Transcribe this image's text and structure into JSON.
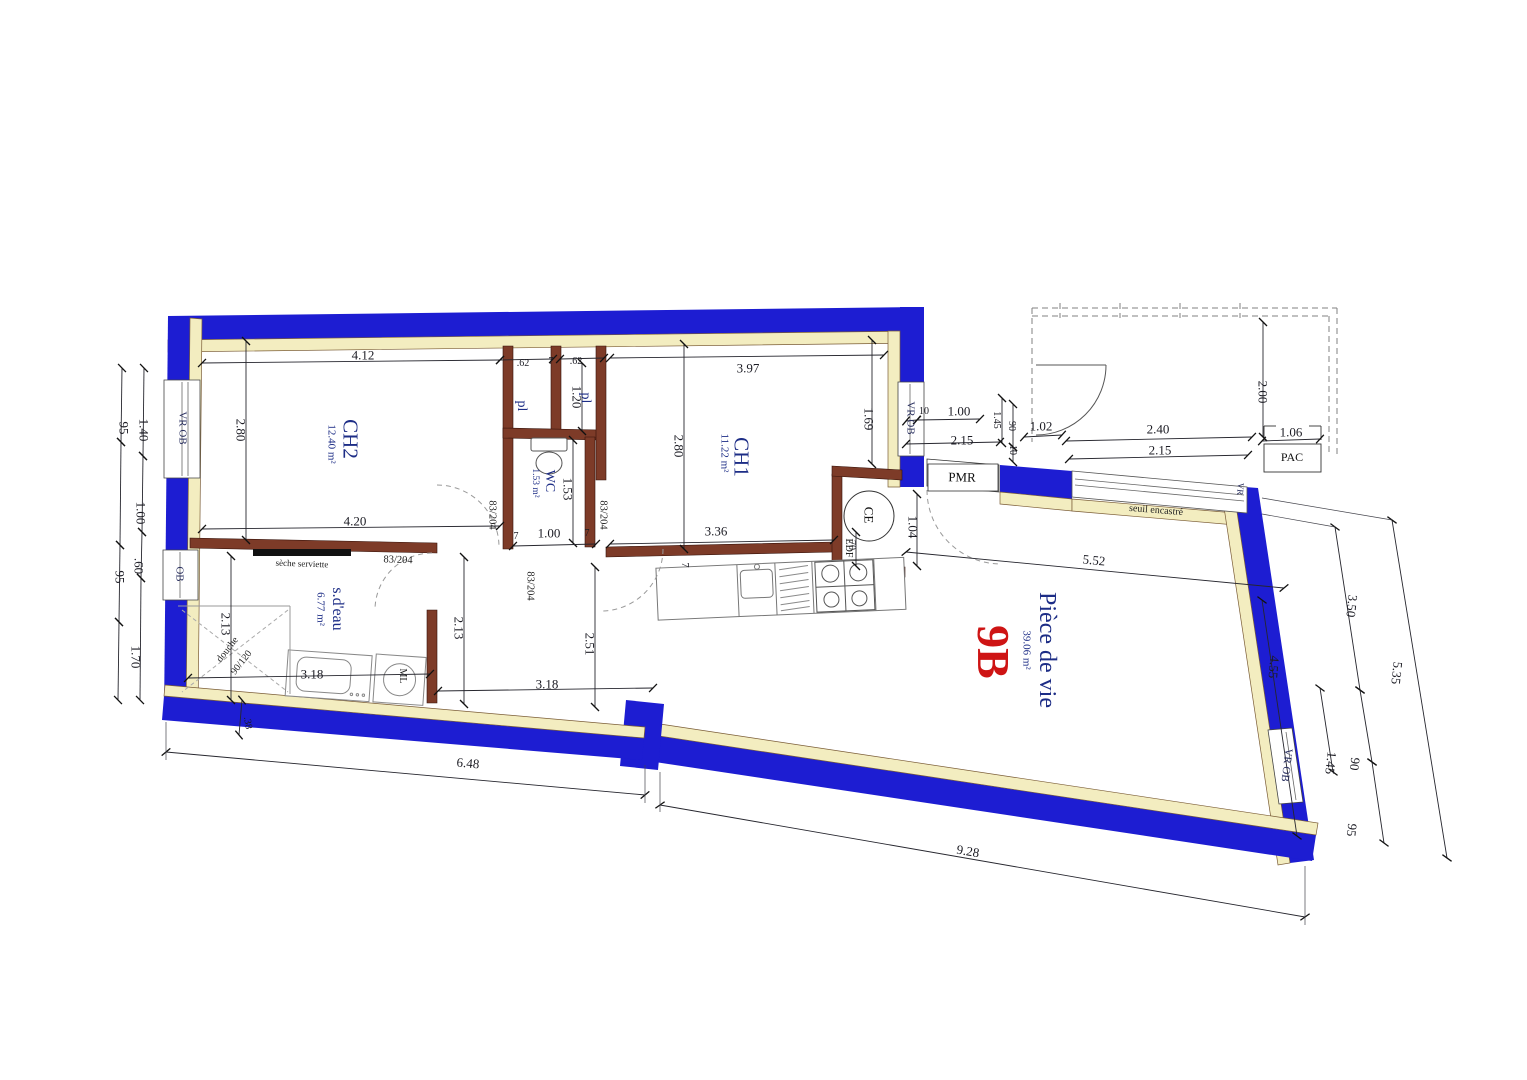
{
  "document": {
    "kind": "architectural floor plan",
    "unit": "9B"
  },
  "colors": {
    "exterior_wall": "#1d1dd2",
    "insulation": "#f3edc0",
    "partition": "#7d3b28",
    "room_text": "#1d2d86",
    "unit_text": "#ce1414",
    "dim_text": "#1c1c24"
  },
  "rooms": [
    {
      "name": "CH2",
      "area": "12.40 m²"
    },
    {
      "name": "CH1",
      "area": "11.22 m²"
    },
    {
      "name": "WC",
      "area": "1.53 m²"
    },
    {
      "name": "s.d'eau",
      "area": "6.77 m²"
    },
    {
      "name": "Pièce de vie",
      "area": "39.06 m²"
    }
  ],
  "plan": {
    "labels": [
      {
        "n": "dim-412",
        "t": "4.12",
        "x": 363,
        "y": 355,
        "r": 0,
        "c": "dim"
      },
      {
        "n": "dim-62a",
        "t": ".62",
        "x": 523,
        "y": 364,
        "r": 0,
        "c": "dim-sm"
      },
      {
        "n": "dim-7a",
        "t": "7",
        "x": 551,
        "y": 362,
        "r": 0,
        "c": "dim-sm"
      },
      {
        "n": "dim-62b",
        "t": ".62",
        "x": 576,
        "y": 362,
        "r": 0,
        "c": "dim-sm"
      },
      {
        "n": "dim-397",
        "t": "3.97",
        "x": 748,
        "y": 368,
        "r": 0,
        "c": "dim"
      },
      {
        "n": "dim-280-ch2",
        "t": "2.80",
        "x": 241,
        "y": 430,
        "r": 90,
        "c": "dim"
      },
      {
        "n": "dim-280-ch1",
        "t": "2.80",
        "x": 679,
        "y": 446,
        "r": 90,
        "c": "dim"
      },
      {
        "n": "dim-169",
        "t": "1.69",
        "x": 869,
        "y": 419,
        "r": 90,
        "c": "dim"
      },
      {
        "n": "dim-120",
        "t": "1.20",
        "x": 577,
        "y": 397,
        "r": 90,
        "c": "dim"
      },
      {
        "n": "dim-153",
        "t": "1.53",
        "x": 568,
        "y": 489,
        "r": 90,
        "c": "dim"
      },
      {
        "n": "dim-420",
        "t": "4.20",
        "x": 355,
        "y": 521,
        "r": 0,
        "c": "dim"
      },
      {
        "n": "dim-7b",
        "t": "7",
        "x": 516,
        "y": 537,
        "r": 0,
        "c": "dim-sm"
      },
      {
        "n": "dim-100-wc",
        "t": "1.00",
        "x": 549,
        "y": 533,
        "r": 0,
        "c": "dim"
      },
      {
        "n": "dim-7c",
        "t": "7",
        "x": 587,
        "y": 534,
        "r": 0,
        "c": "dim-sm"
      },
      {
        "n": "dim-336",
        "t": "3.36",
        "x": 716,
        "y": 531,
        "r": 0,
        "c": "dim"
      },
      {
        "n": "dim-70",
        "t": "70",
        "x": 851,
        "y": 545,
        "r": 90,
        "c": "dim-sm"
      },
      {
        "n": "dim-104",
        "t": "1.04",
        "x": 913,
        "y": 527,
        "r": 90,
        "c": "dim"
      },
      {
        "n": "dim-213-l",
        "t": "2.13",
        "x": 226,
        "y": 624,
        "r": 90,
        "c": "dim"
      },
      {
        "n": "dim-213-r",
        "t": "2.13",
        "x": 459,
        "y": 628,
        "r": 90,
        "c": "dim"
      },
      {
        "n": "dim-318-a",
        "t": "3.18",
        "x": 312,
        "y": 674,
        "r": 0,
        "c": "dim"
      },
      {
        "n": "dim-318-b",
        "t": "3.18",
        "x": 547,
        "y": 684,
        "r": 0,
        "c": "dim"
      },
      {
        "n": "dim-251",
        "t": "2.51",
        "x": 590,
        "y": 644,
        "r": 90,
        "c": "dim"
      },
      {
        "n": "dim-38",
        "t": ".38",
        "x": 247,
        "y": 723,
        "r": 80,
        "c": "dim-sm"
      },
      {
        "n": "dim-648",
        "t": "6.48",
        "x": 468,
        "y": 763,
        "r": 5,
        "c": "dim"
      },
      {
        "n": "dim-928",
        "t": "9.28",
        "x": 968,
        "y": 851,
        "r": 9.5,
        "c": "dim"
      },
      {
        "n": "dim-552",
        "t": "5.52",
        "x": 1094,
        "y": 560,
        "r": 5.5,
        "c": "dim"
      },
      {
        "n": "dim-455",
        "t": "4.55",
        "x": 1274,
        "y": 667,
        "r": 95,
        "c": "dim"
      },
      {
        "n": "dim-350",
        "t": "3.50",
        "x": 1352,
        "y": 606,
        "r": 96,
        "c": "dim"
      },
      {
        "n": "dim-90-r",
        "t": "90",
        "x": 1355,
        "y": 764,
        "r": 96,
        "c": "dim"
      },
      {
        "n": "dim-145-r",
        "t": "1.45",
        "x": 1331,
        "y": 763,
        "r": 96,
        "c": "dim"
      },
      {
        "n": "dim-95-r",
        "t": "95",
        "x": 1352,
        "y": 830,
        "r": 96,
        "c": "dim"
      },
      {
        "n": "dim-535",
        "t": "5.35",
        "x": 1397,
        "y": 673,
        "r": 96,
        "c": "dim"
      },
      {
        "n": "dim-140",
        "t": "1.40",
        "x": 144,
        "y": 430,
        "r": 90,
        "c": "dim"
      },
      {
        "n": "dim-95-a",
        "t": "95",
        "x": 124,
        "y": 428,
        "r": 90,
        "c": "dim"
      },
      {
        "n": "dim-100-l",
        "t": "1.00",
        "x": 141,
        "y": 513,
        "r": 90,
        "c": "dim"
      },
      {
        "n": "dim-60",
        "t": ".60",
        "x": 139,
        "y": 566,
        "r": 90,
        "c": "dim"
      },
      {
        "n": "dim-95-b",
        "t": "95",
        "x": 120,
        "y": 577,
        "r": 90,
        "c": "dim"
      },
      {
        "n": "dim-170",
        "t": "1.70",
        "x": 136,
        "y": 657,
        "r": 90,
        "c": "dim"
      },
      {
        "n": "dim-10-a",
        "t": "10",
        "x": 924,
        "y": 412,
        "r": 0,
        "c": "dim-sm"
      },
      {
        "n": "dim-100-p",
        "t": "1.00",
        "x": 959,
        "y": 411,
        "r": 0,
        "c": "dim"
      },
      {
        "n": "dim-215-p",
        "t": "2.15",
        "x": 962,
        "y": 440,
        "r": 0,
        "c": "dim"
      },
      {
        "n": "dim-145-p",
        "t": "1.45",
        "x": 996,
        "y": 420,
        "r": 90,
        "c": "dim-sm"
      },
      {
        "n": "dim-90-p",
        "t": "90",
        "x": 1011,
        "y": 426,
        "r": 90,
        "c": "dim-sm"
      },
      {
        "n": "dim-10-p",
        "t": "10",
        "x": 1012,
        "y": 450,
        "r": 90,
        "c": "dim-sm"
      },
      {
        "n": "dim-102",
        "t": "1.02",
        "x": 1041,
        "y": 426,
        "r": 0,
        "c": "dim"
      },
      {
        "n": "dim-240",
        "t": "2.40",
        "x": 1158,
        "y": 429,
        "r": 0,
        "c": "dim"
      },
      {
        "n": "dim-215-q",
        "t": "2.15",
        "x": 1160,
        "y": 450,
        "r": 0,
        "c": "dim"
      },
      {
        "n": "dim-200",
        "t": "2.00",
        "x": 1263,
        "y": 392,
        "r": 90,
        "c": "dim"
      },
      {
        "n": "dim-106",
        "t": "1.06",
        "x": 1291,
        "y": 432,
        "r": 0,
        "c": "dim"
      },
      {
        "n": "dim-7-kitchen",
        "t": "7",
        "x": 684,
        "y": 565,
        "r": 90,
        "c": "dim-sm"
      },
      {
        "n": "room-ch2-name",
        "t": "CH2",
        "x": 350,
        "y": 439,
        "r": 90,
        "c": "room"
      },
      {
        "n": "room-ch2-area",
        "t": "12.40 m²",
        "x": 331,
        "y": 444,
        "r": 90,
        "c": "area"
      },
      {
        "n": "room-ch1-name",
        "t": "CH1",
        "x": 741,
        "y": 457,
        "r": 90,
        "c": "room"
      },
      {
        "n": "room-ch1-area",
        "t": "11.22 m²",
        "x": 724,
        "y": 453,
        "r": 90,
        "c": "area"
      },
      {
        "n": "room-wc-name",
        "t": "WC",
        "x": 549,
        "y": 481,
        "r": 90,
        "c": "room-sm"
      },
      {
        "n": "room-wc-area",
        "t": "1.53 m²",
        "x": 534,
        "y": 483,
        "r": 90,
        "c": "area-sm"
      },
      {
        "n": "room-sdeau-name",
        "t": "s.d'eau",
        "x": 337,
        "y": 609,
        "r": 90,
        "c": "room-sm2"
      },
      {
        "n": "room-sdeau-area",
        "t": "6.77 m²",
        "x": 320,
        "y": 609,
        "r": 90,
        "c": "area"
      },
      {
        "n": "room-vie-name",
        "t": "Pièce de vie",
        "x": 1047,
        "y": 650,
        "r": 90,
        "c": "room-lg"
      },
      {
        "n": "room-vie-area",
        "t": "39.06 m²",
        "x": 1026,
        "y": 650,
        "r": 90,
        "c": "area"
      },
      {
        "n": "unit-label",
        "t": "9B",
        "x": 993,
        "y": 652,
        "r": 90,
        "c": "unit"
      },
      {
        "n": "closet-pl-left",
        "t": "pl",
        "x": 521,
        "y": 406,
        "r": 90,
        "c": "room-sm"
      },
      {
        "n": "closet-pl-right",
        "t": "pl",
        "x": 585,
        "y": 398,
        "r": 90,
        "c": "room-sm"
      },
      {
        "n": "window-vrob-left",
        "t": "VR OB",
        "x": 182,
        "y": 428,
        "r": 90,
        "c": "win"
      },
      {
        "n": "window-ob-left",
        "t": "OB",
        "x": 179,
        "y": 574,
        "r": 90,
        "c": "win"
      },
      {
        "n": "window-vrob-top",
        "t": "VR OB",
        "x": 910,
        "y": 418,
        "r": 90,
        "c": "win"
      },
      {
        "n": "window-vrob-right",
        "t": "VR OB",
        "x": 1286,
        "y": 765,
        "r": 97,
        "c": "win"
      },
      {
        "n": "window-vr-bay",
        "t": "VR",
        "x": 1240,
        "y": 489,
        "r": 95,
        "c": "win-sm"
      },
      {
        "n": "door-83204-sdeau",
        "t": "83/204",
        "x": 398,
        "y": 561,
        "r": 2,
        "c": "door"
      },
      {
        "n": "door-83204-ch2",
        "t": "83/204",
        "x": 491,
        "y": 515,
        "r": 90,
        "c": "door"
      },
      {
        "n": "door-83204-ch1",
        "t": "83/204",
        "x": 602,
        "y": 515,
        "r": 90,
        "c": "door"
      },
      {
        "n": "door-83204-hall",
        "t": "83/204",
        "x": 529,
        "y": 586,
        "r": 90,
        "c": "door"
      },
      {
        "n": "label-pmr",
        "t": "PMR",
        "x": 962,
        "y": 477,
        "r": 1,
        "c": "box"
      },
      {
        "n": "label-pac",
        "t": "PAC",
        "x": 1292,
        "y": 457,
        "r": 0,
        "c": "box-sm"
      },
      {
        "n": "label-seuil",
        "t": "seuil encastré",
        "x": 1156,
        "y": 511,
        "r": 4.5,
        "c": "note"
      },
      {
        "n": "label-seche",
        "t": "sèche serviette",
        "x": 302,
        "y": 564,
        "r": 2,
        "c": "note-sm"
      },
      {
        "n": "label-douche",
        "t": "douche",
        "x": 228,
        "y": 650,
        "r": -52,
        "c": "note"
      },
      {
        "n": "label-douche-size",
        "t": "90/120",
        "x": 242,
        "y": 663,
        "r": -52,
        "c": "note"
      },
      {
        "n": "label-ml",
        "t": "ML",
        "x": 402,
        "y": 676,
        "r": 90,
        "c": "note"
      },
      {
        "n": "label-ce",
        "t": "CE",
        "x": 869,
        "y": 515,
        "r": 90,
        "c": "ce-t"
      },
      {
        "n": "label-edf",
        "t": "EDF",
        "x": 848,
        "y": 548,
        "r": 90,
        "c": "note"
      }
    ]
  }
}
